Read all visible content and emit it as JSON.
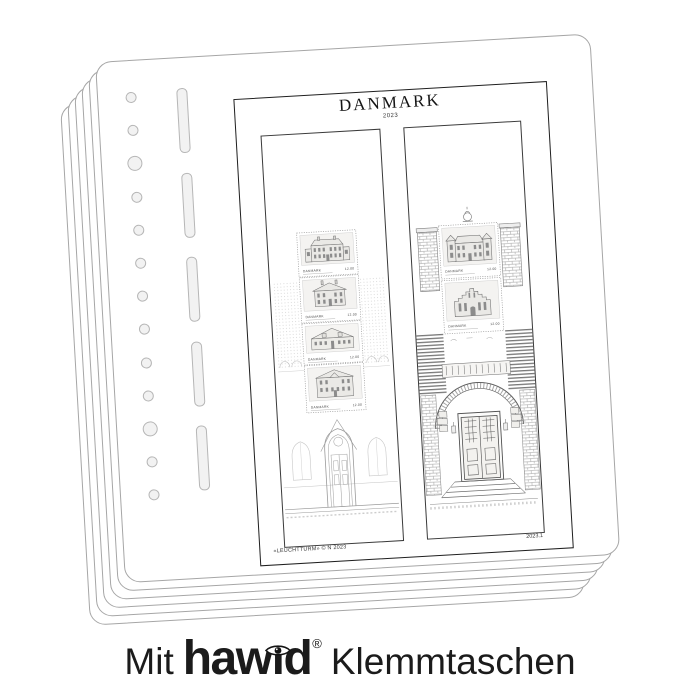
{
  "album_page": {
    "title": "DANMARK",
    "year": "2023",
    "copyright": "«LEUCHTTURM» © N 2023",
    "sheet_code": "2023.1"
  },
  "stamps": {
    "country": "DANMARK",
    "strip": [
      {
        "value": "12.00"
      },
      {
        "value": "12.00"
      },
      {
        "value": "12.00"
      },
      {
        "value": "12.00"
      }
    ],
    "sheet": [
      {
        "value": "12.00"
      },
      {
        "value": "12.00"
      }
    ]
  },
  "caption": {
    "prefix": "Mit",
    "brand": "hawid",
    "brand_pre": "haw",
    "brand_i": "ı",
    "brand_post": "d",
    "registered": "®",
    "suffix": "Klemmtaschen"
  },
  "binder": {
    "circle_count": 13,
    "large_indices": [
      2,
      10
    ],
    "circle_start_y": 31,
    "circle_spacing": 33.2,
    "slot_count": 5,
    "slot_start_y": 30,
    "slot_spacing": 84.5
  },
  "colors": {
    "page_border": "#a6a6a6",
    "frame_border": "#1f1f1f",
    "pocket_border": "#3a3a3a",
    "hole_fill": "#f2f2f2",
    "hole_border": "#b6b6b6",
    "caption_text": "#1b1b1b"
  }
}
